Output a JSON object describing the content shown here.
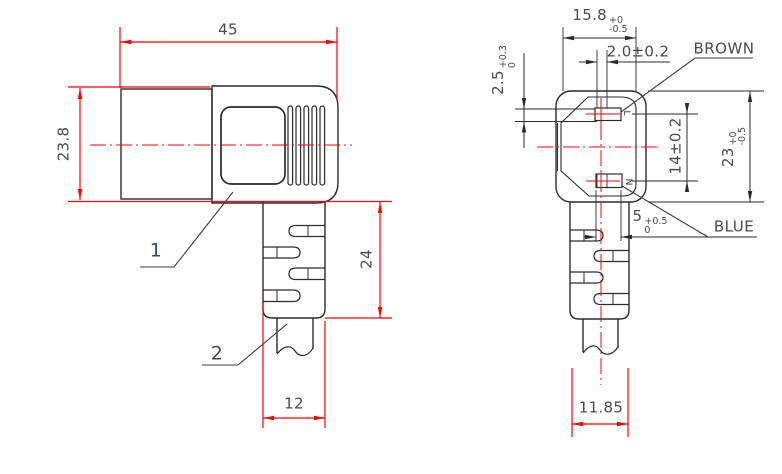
{
  "side_view": {
    "dim_width": "45",
    "dim_height": "23.8",
    "dim_sr_length": "24",
    "dim_cable_width": "12",
    "label_body": "1",
    "label_cable": "2"
  },
  "face_view": {
    "dim_face_width": {
      "value": "15.8",
      "tp": "+0",
      "tm": "-0.5"
    },
    "dim_slot_width": "2.0±0.2",
    "dim_slot_height": {
      "value": "2.5",
      "tp": "+0.3",
      "tm": "0"
    },
    "dim_pin_pitch": "14±0.2",
    "dim_face_height": {
      "value": "23",
      "tp": "+0",
      "tm": "-0.5"
    },
    "dim_pin_offset": {
      "value": "5",
      "tp": "+0.5",
      "tm": "0"
    },
    "dim_sr_width": "11.85",
    "wire_live": "BROWN",
    "wire_neutral": "BLUE",
    "mark_live": "L",
    "mark_neutral": "N"
  },
  "colors": {
    "dimension_red": "#ff0000",
    "outline_black": "#2b2b2b",
    "text_gray": "#4a4a4a"
  }
}
